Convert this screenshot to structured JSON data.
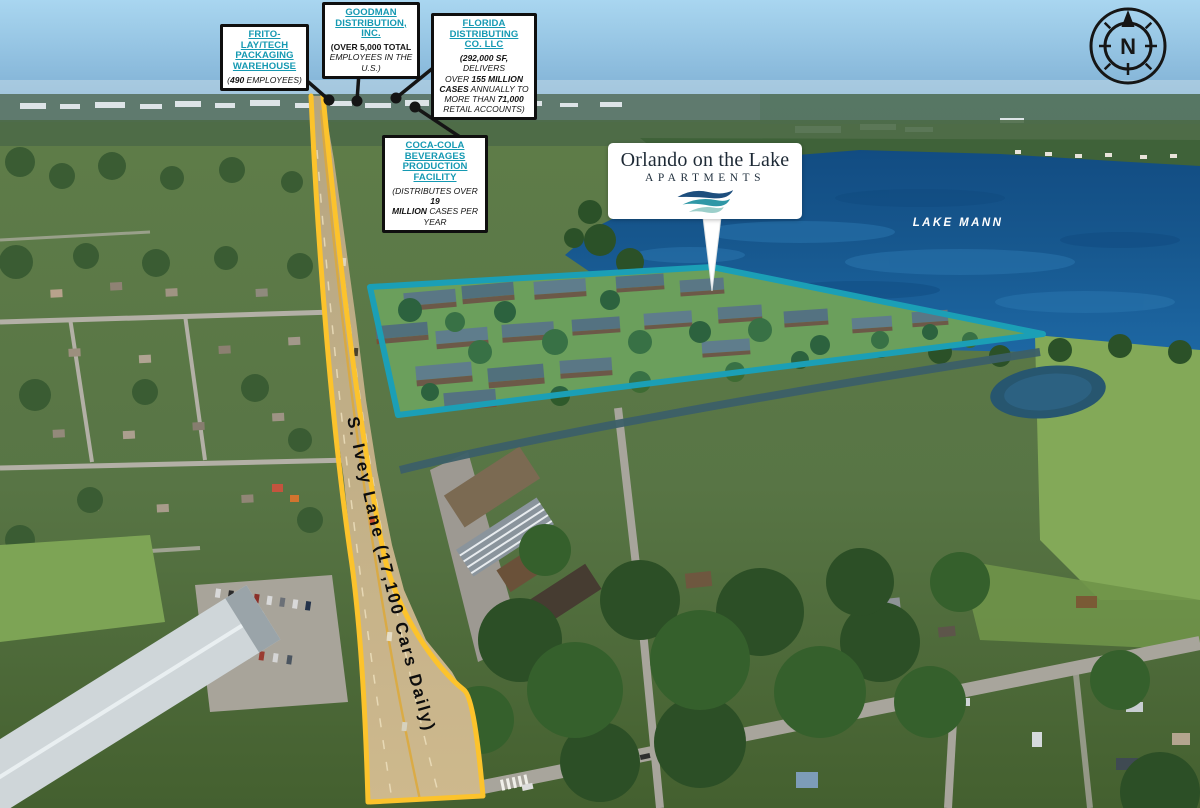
{
  "title": "Orlando on the Lake Apartments aerial site map",
  "colors": {
    "accent_teal": "#1599b2",
    "property_outline_teal": "#1b9fb6",
    "road_highlight_yellow": "#fcc32c",
    "lake_blue": "#17548c",
    "sign_navy": "#1d2935"
  },
  "compass": {
    "letter": "N",
    "icon": "compass-rose-icon"
  },
  "lake": {
    "label": "LAKE MANN"
  },
  "road": {
    "label": "S. Ivey Lane (17,100 Cars Daily)"
  },
  "sign": {
    "title": "Orlando on the Lake",
    "subtitle": "APARTMENTS",
    "logo_icon": "lake-waves-logo-icon"
  },
  "callouts": [
    {
      "name": "frito-lay-tech-packaging-warehouse",
      "title": "FRITO-LAY/TECH\nPACKAGING\nWAREHOUSE",
      "body": [
        {
          "t": "("
        },
        {
          "t": "490",
          "b": true
        },
        {
          "t": " EMPLOYEES)"
        }
      ]
    },
    {
      "name": "goodman-distribution-inc",
      "title": "GOODMAN\nDISTRIBUTION,\nINC.",
      "body": [
        {
          "t": "(OVER 5,000 TOTAL",
          "b": true,
          "u": true
        },
        {
          "t": "\nEMPLOYEES IN THE U.S.)"
        }
      ]
    },
    {
      "name": "florida-distributing-co-llc",
      "title": "FLORIDA\nDISTRIBUTING\nCO. LLC",
      "body": [
        {
          "t": "(292,000 SF,",
          "b": true
        },
        {
          "t": " DELIVERS\nOVER "
        },
        {
          "t": "155 MILLION",
          "b": true
        },
        {
          "t": "\n"
        },
        {
          "t": "CASES",
          "b": true
        },
        {
          "t": " ANNUALLY TO\nMORE THAN "
        },
        {
          "t": "71,000",
          "b": true
        },
        {
          "t": "\nRETAIL ACCOUNTS)"
        }
      ]
    },
    {
      "name": "coca-cola-beverages-production-facility",
      "title": "COCA-COLA\nBEVERAGES\nPRODUCTION\nFACILITY",
      "body": [
        {
          "t": "(DISTRIBUTES OVER "
        },
        {
          "t": "19\nMILLION",
          "b": true
        },
        {
          "t": " CASES PER YEAR"
        }
      ]
    }
  ]
}
